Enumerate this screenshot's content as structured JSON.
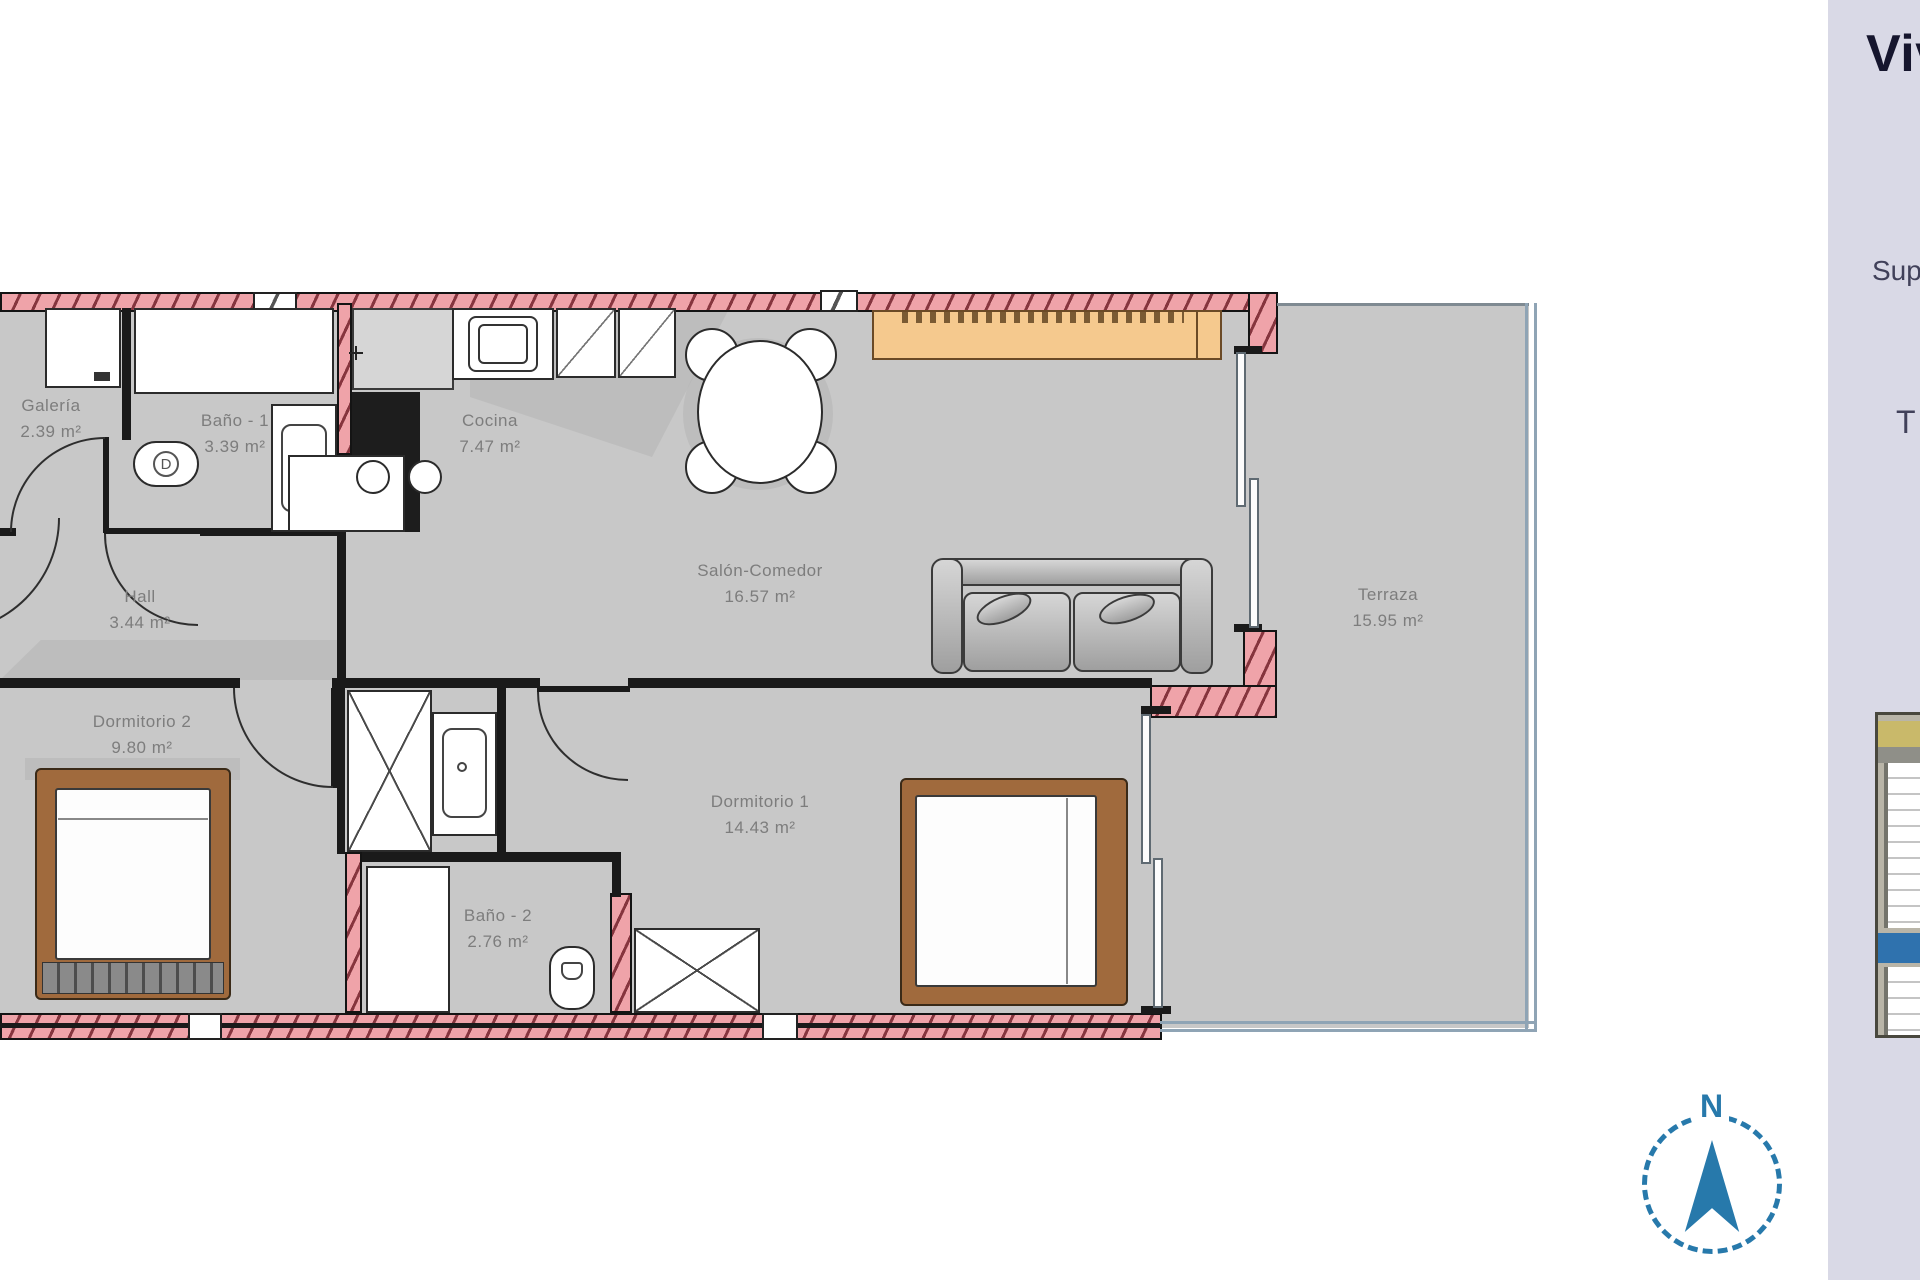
{
  "plan": {
    "rooms": [
      {
        "name": "Galería",
        "area": "2.39 m²"
      },
      {
        "name": "Baño - 1",
        "area": "3.39 m²"
      },
      {
        "name": "Cocina",
        "area": "7.47 m²"
      },
      {
        "name": "Salón-Comedor",
        "area": "16.57 m²"
      },
      {
        "name": "Hall",
        "area": "3.44 m²"
      },
      {
        "name": "Dormitorio 2",
        "area": "9.80 m²"
      },
      {
        "name": "Dormitorio 1",
        "area": "14.43 m²"
      },
      {
        "name": "Baño - 2",
        "area": "2.76 m²"
      },
      {
        "name": "Terraza",
        "area": "15.95 m²"
      }
    ],
    "colors": {
      "wall_fill": "#efa3a9",
      "wall_hatch": "#86353e",
      "floor": "#c8c8c8",
      "sideboard": "#f5c98e",
      "bed_frame": "#a06a3d",
      "accent_blue": "#2779ab",
      "highlight_band": "#2f72ae"
    }
  },
  "sidebar": {
    "title": "Viv",
    "label_superficie": "Sup",
    "label_t": "T"
  },
  "compass": {
    "north_label": "N"
  }
}
